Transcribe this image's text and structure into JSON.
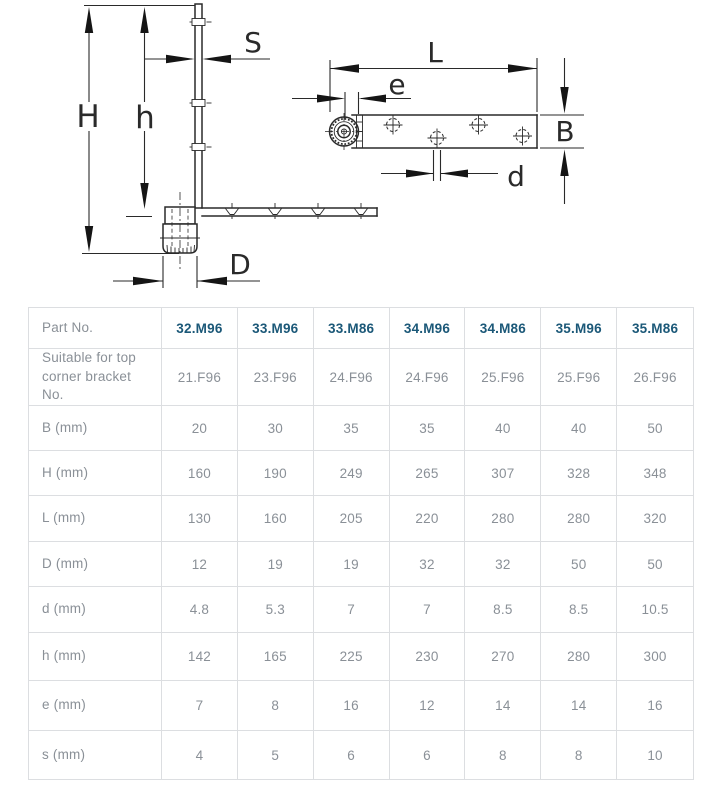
{
  "diagram": {
    "labels": {
      "S": "S",
      "H": "H",
      "h": "h",
      "D": "D",
      "L": "L",
      "e": "e",
      "B": "B",
      "d": "d"
    }
  },
  "table": {
    "header": {
      "label": "Part No.",
      "parts": [
        "32.M96",
        "33.M96",
        "33.M86",
        "34.M96",
        "34.M86",
        "35.M96",
        "35.M86"
      ]
    },
    "rows": [
      {
        "label": "Suitable for top corner bracket No.",
        "values": [
          "21.F96",
          "23.F96",
          "24.F96",
          "24.F96",
          "25.F96",
          "25.F96",
          "26.F96"
        ]
      },
      {
        "label": "B (mm)",
        "values": [
          "20",
          "30",
          "35",
          "35",
          "40",
          "40",
          "50"
        ]
      },
      {
        "label": "H (mm)",
        "values": [
          "160",
          "190",
          "249",
          "265",
          "307",
          "328",
          "348"
        ]
      },
      {
        "label": "L (mm)",
        "values": [
          "130",
          "160",
          "205",
          "220",
          "280",
          "280",
          "320"
        ]
      },
      {
        "label": "D (mm)",
        "values": [
          "12",
          "19",
          "19",
          "32",
          "32",
          "50",
          "50"
        ]
      },
      {
        "label": "d (mm)",
        "values": [
          "4.8",
          "5.3",
          "7",
          "7",
          "8.5",
          "8.5",
          "10.5"
        ]
      },
      {
        "label": "h (mm)",
        "values": [
          "142",
          "165",
          "225",
          "230",
          "270",
          "280",
          "300"
        ]
      },
      {
        "label": "e (mm)",
        "values": [
          "7",
          "8",
          "16",
          "12",
          "14",
          "14",
          "16"
        ]
      },
      {
        "label": "s (mm)",
        "values": [
          "4",
          "5",
          "6",
          "6",
          "8",
          "8",
          "10"
        ]
      }
    ]
  },
  "colors": {
    "accent_blue": "#1b5878",
    "text_gray": "#8a9097",
    "border_gray": "#dcdee1",
    "line_black": "#2a2a2a"
  }
}
